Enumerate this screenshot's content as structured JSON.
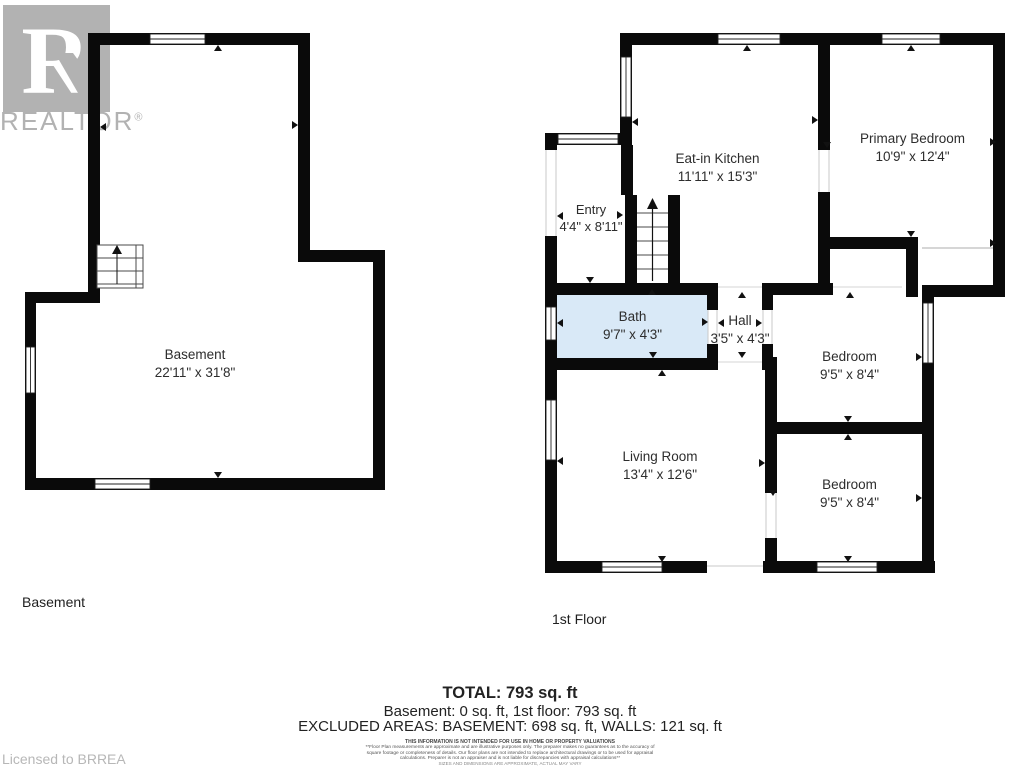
{
  "watermark": {
    "logo_letter": "R",
    "brand": "REALTOR",
    "registered_mark": "®",
    "licensed": "Licensed to BRREA"
  },
  "basement": {
    "floor_title": "Basement",
    "room_name": "Basement",
    "room_dims": "22'11\" x 31'8\""
  },
  "first_floor": {
    "floor_title": "1st Floor",
    "rooms": {
      "kitchen": {
        "name": "Eat-in Kitchen",
        "dims": "11'11\" x 15'3\""
      },
      "primary_bedroom": {
        "name": "Primary Bedroom",
        "dims": "10'9\" x 12'4\""
      },
      "entry": {
        "name": "Entry",
        "dims": "4'4\" x 8'11\""
      },
      "bath": {
        "name": "Bath",
        "dims": "9'7\" x 4'3\""
      },
      "hall": {
        "name": "Hall",
        "dims": "3'5\" x 4'3\""
      },
      "bedroom_top": {
        "name": "Bedroom",
        "dims": "9'5\" x 8'4\""
      },
      "bedroom_bottom": {
        "name": "Bedroom",
        "dims": "9'5\" x 8'4\""
      },
      "living_room": {
        "name": "Living Room",
        "dims": "13'4\" x 12'6\""
      }
    }
  },
  "summary": {
    "total": "TOTAL: 793 sq. ft",
    "floors_line": "Basement: 0 sq. ft, 1st floor: 793 sq. ft",
    "excluded_line": "EXCLUDED AREAS: BASEMENT: 698 sq. ft, WALLS: 121 sq. ft",
    "disclaimer_heading": "THIS INFORMATION IS NOT INTENDED FOR USE IN HOME OR PROPERTY VALUATIONS",
    "disclaimer_body": "**Floor Plan measurements are approximate and are illustrative purposes only. The preparer makes no guarantees as to the accuracy of square footage or completeness of details. Our floor plans are not intended to replace architectural drawings or to be used for appraisal calculations. Preparer is not an appraiser and is not liable for discrepancies with appraisal calculations**",
    "disclaimer_note": "SIZES AND DIMENSIONS ARE APPROXIMATE, ACTUAL MAY VARY"
  },
  "colors": {
    "wall": "#0a0a0a",
    "bath_fill": "#d9e9f7",
    "watermark": "#b2b2b2"
  }
}
